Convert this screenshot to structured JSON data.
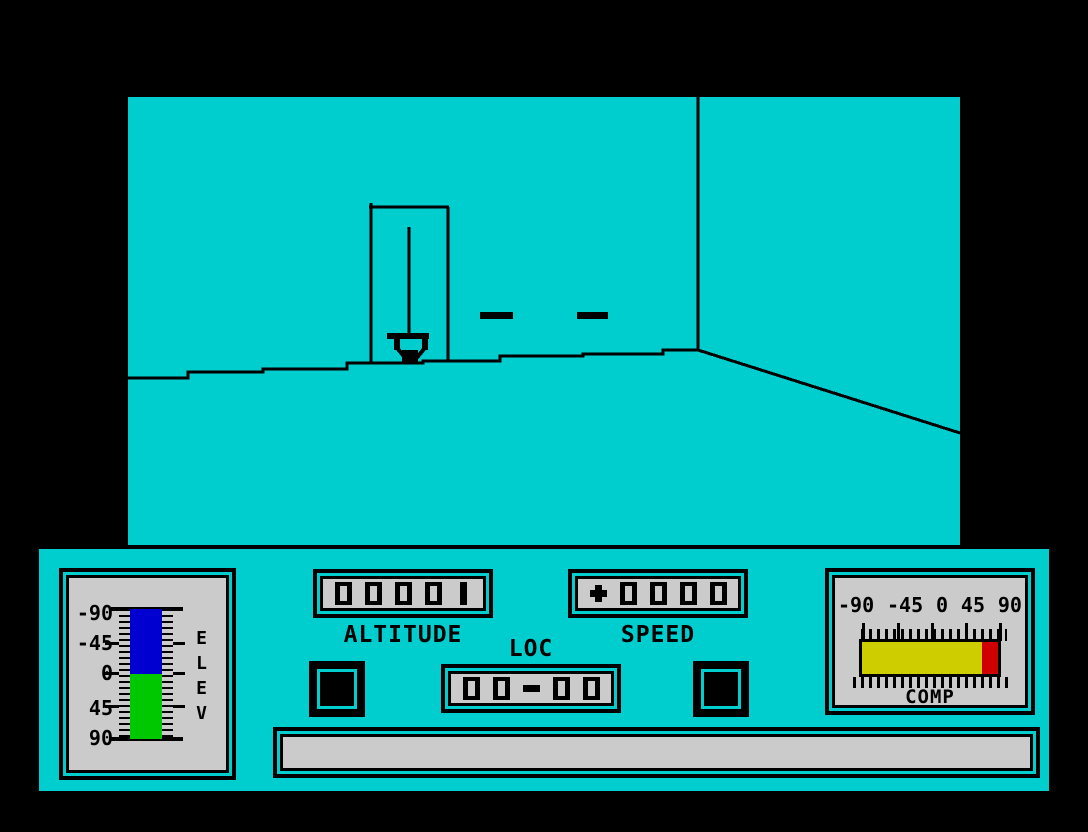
{
  "colors": {
    "background": "#000000",
    "cyan": "#00CDCD",
    "instrument_face": "#CBCBCB",
    "line": "#000000",
    "elev_negative": "#0000D0",
    "elev_positive": "#00C800",
    "comp_bar": "#CDCD00",
    "comp_marker": "#D00000"
  },
  "scene": {
    "objects": [
      "tower-outline",
      "beacon-mast",
      "beacon-base",
      "ground-dash",
      "ground-dash",
      "wall-corner-line",
      "ground-line",
      "perspective-edge"
    ]
  },
  "instruments": {
    "elev": {
      "title": "ELEV",
      "scale": [
        "-90",
        "-45",
        "0",
        "45",
        "90"
      ],
      "bar_segments": [
        {
          "from": "-90",
          "to": "0",
          "color": "#0000D0"
        },
        {
          "from": "0",
          "to": "90",
          "color": "#00C800"
        }
      ]
    },
    "altitude": {
      "title": "ALTITUDE",
      "value": "00001"
    },
    "speed": {
      "title": "SPEED",
      "value": "+0000"
    },
    "loc": {
      "title": "LOC",
      "value": "00-00"
    },
    "comp": {
      "title": "COMP",
      "scale": [
        "-90",
        "-45",
        "0",
        "45",
        "90"
      ],
      "bar_segments": [
        {
          "from": "-90",
          "to": "75",
          "color": "#CDCD00"
        },
        {
          "from": "75",
          "to": "90",
          "color": "#D00000"
        }
      ]
    },
    "message_bar": {
      "value": ""
    }
  }
}
